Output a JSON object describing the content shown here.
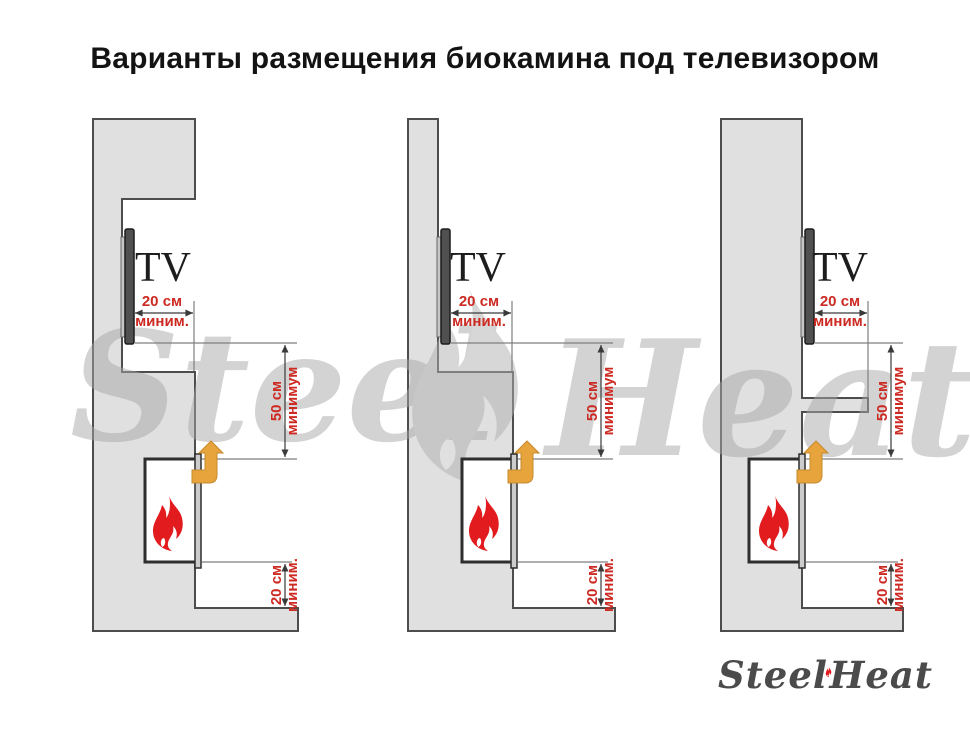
{
  "title": "Варианты размещения биокамина под телевизором",
  "watermark": {
    "steel": "Steel",
    "heat": "Heat"
  },
  "logo": {
    "steel": "Steel",
    "heat": "Heat"
  },
  "diagrams": [
    {
      "tv": "TV",
      "top": {
        "value": "20 см",
        "qual": "миним."
      },
      "mid": {
        "value": "50 см",
        "qual": "минимум"
      },
      "bottom": {
        "value": "20 см",
        "qual": "миним."
      }
    },
    {
      "tv": "TV",
      "top": {
        "value": "20 см",
        "qual": "миним."
      },
      "mid": {
        "value": "50 см",
        "qual": "минимум"
      },
      "bottom": {
        "value": "20 см",
        "qual": "миним."
      }
    },
    {
      "tv": "TV",
      "top": {
        "value": "20 см",
        "qual": "миним."
      },
      "mid": {
        "value": "50 см",
        "qual": "минимум"
      },
      "bottom": {
        "value": "20 см",
        "qual": "миним."
      }
    }
  ],
  "colors": {
    "accent_red": "#CC2A22",
    "vent_arrow_amber": "#E7A43C",
    "flame_red": "#E21B1E",
    "wall_gray": "#E0E0E0",
    "outline_gray": "#4D4D4D",
    "watermark_gray": "#CFCFCF"
  }
}
